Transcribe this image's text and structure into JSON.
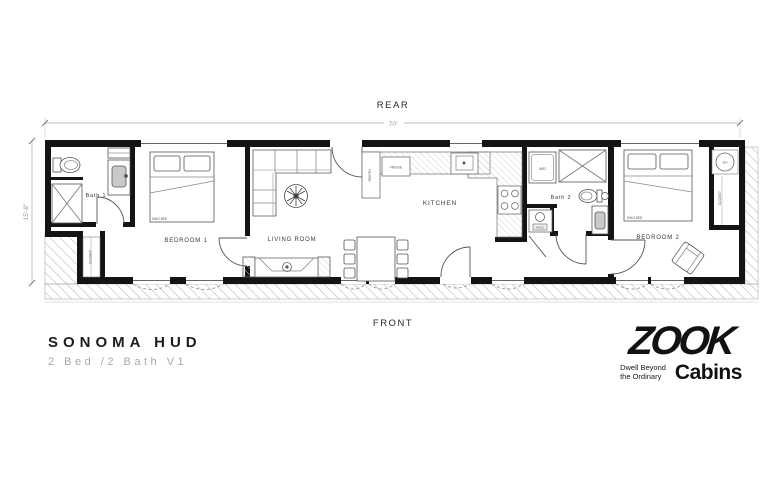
{
  "plan": {
    "rear_label": "REAR",
    "front_label": "FRONT",
    "width_dim": "70'",
    "height_dim": "15'-8\"",
    "wall_color": "#141414",
    "hatch_color": "#b5b5b5"
  },
  "rooms": {
    "bath1": "Bath 1",
    "bedroom1": "BEDROOM 1",
    "living": "LIVING ROOM",
    "kitchen": "KITCHEN",
    "bath2": "Bath 2",
    "bedroom2": "BEDROOM 2",
    "closet_left": "CLOSET",
    "closet_right": "CLOSET"
  },
  "fixtures": {
    "fridge": "FRIDGE",
    "pantry": "PANTRY",
    "washer_dryer": "W/D",
    "hvac": "HVAC",
    "water_heater": "WH",
    "king_bed_1": "KING BED",
    "king_bed_2": "KING BED"
  },
  "title_block": {
    "title": "SONOMA HUD",
    "subtitle": "2 Bed /2 Bath V1"
  },
  "logo": {
    "brand": "ZOOK",
    "tagline1": "Dwell Beyond",
    "tagline2": "the Ordinary",
    "brand_suffix": "Cabins"
  }
}
